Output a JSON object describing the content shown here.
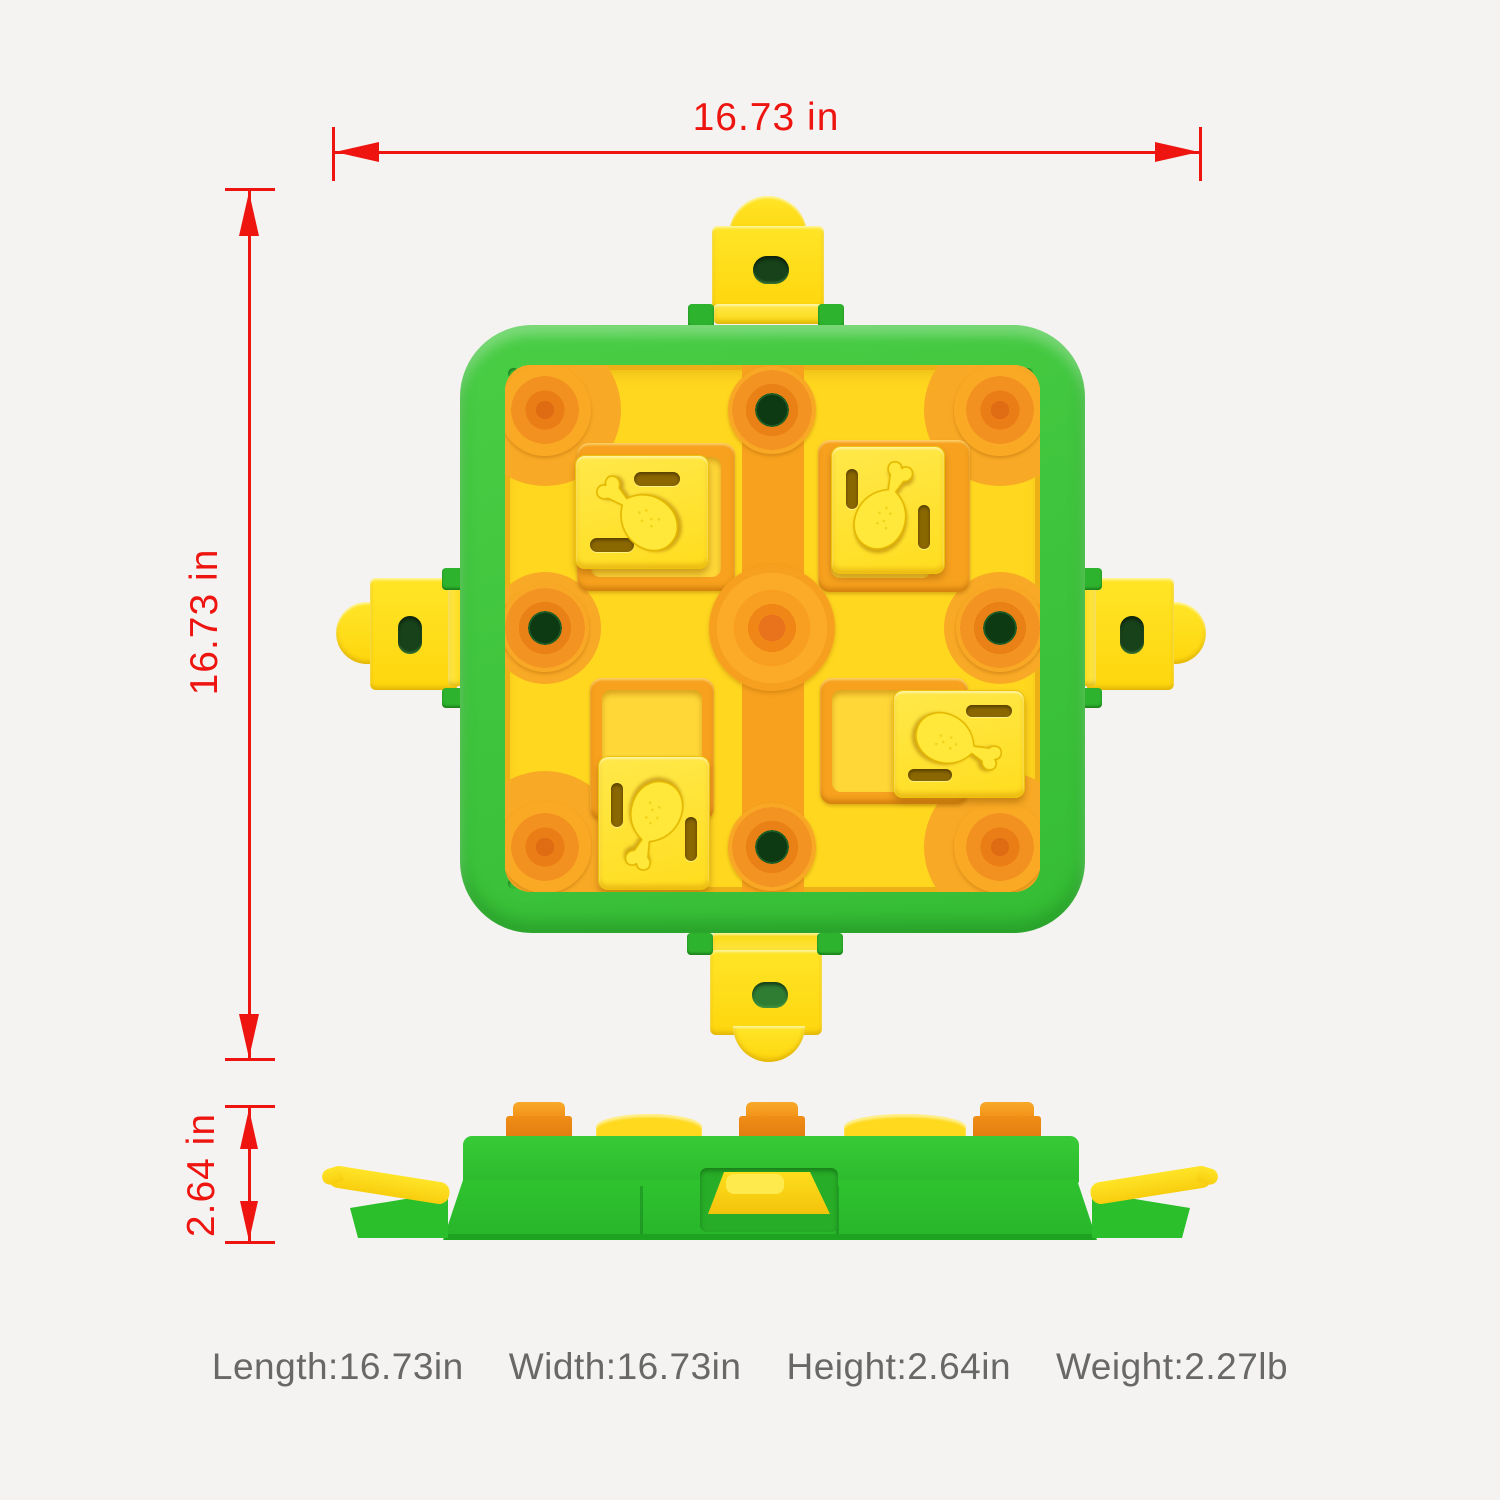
{
  "scene": {
    "background_color": "#f4f3f1",
    "subject": "square dog puzzle feeder toy shown in top view and side view with dimension callouts"
  },
  "colors": {
    "dimension_red": "#ee1410",
    "spec_text_gray": "#686868",
    "frame_green": "#3cc53c",
    "board_yellow": "#ffd71f",
    "track_orange": "#f7a11e",
    "slider_yellow": "#ffe235",
    "clip_yellow": "#ffdf17",
    "hole_dark_green": "#0d3a12"
  },
  "dimensions": {
    "top_width": "16.73 in",
    "left_height": "16.73 in",
    "side_height": "2.64 in"
  },
  "specs": [
    "Length:16.73in",
    "Width:16.73in",
    "Height:2.64in",
    "Weight:2.27lb"
  ]
}
